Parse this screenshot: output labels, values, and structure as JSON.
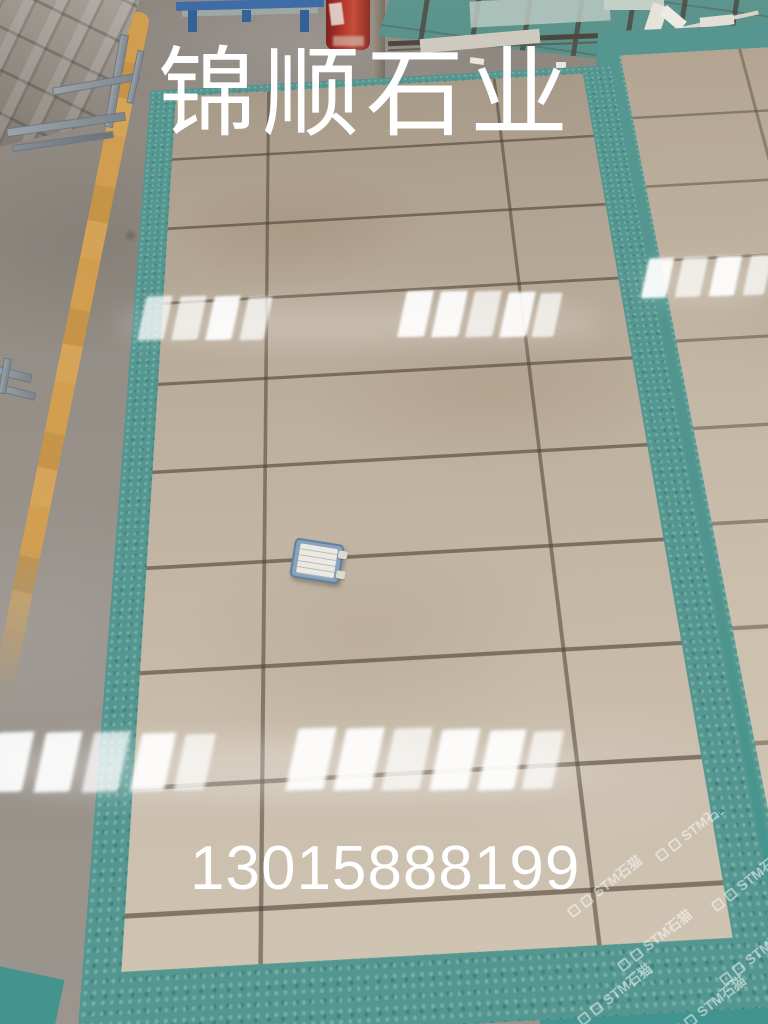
{
  "overlays": {
    "title": "锦顺石业",
    "phone": "13015888199"
  },
  "watermark": {
    "text": "STM石猫"
  },
  "scene": {
    "tile_beige": "#c2b5a3",
    "teal_paint": "#549690",
    "concrete_gray": "#95908a",
    "yellow_line": "#d9a049",
    "barrel_red": "#b03529",
    "stand_blue": "#3d6ca6",
    "overlay_text_color": "#ffffff"
  }
}
